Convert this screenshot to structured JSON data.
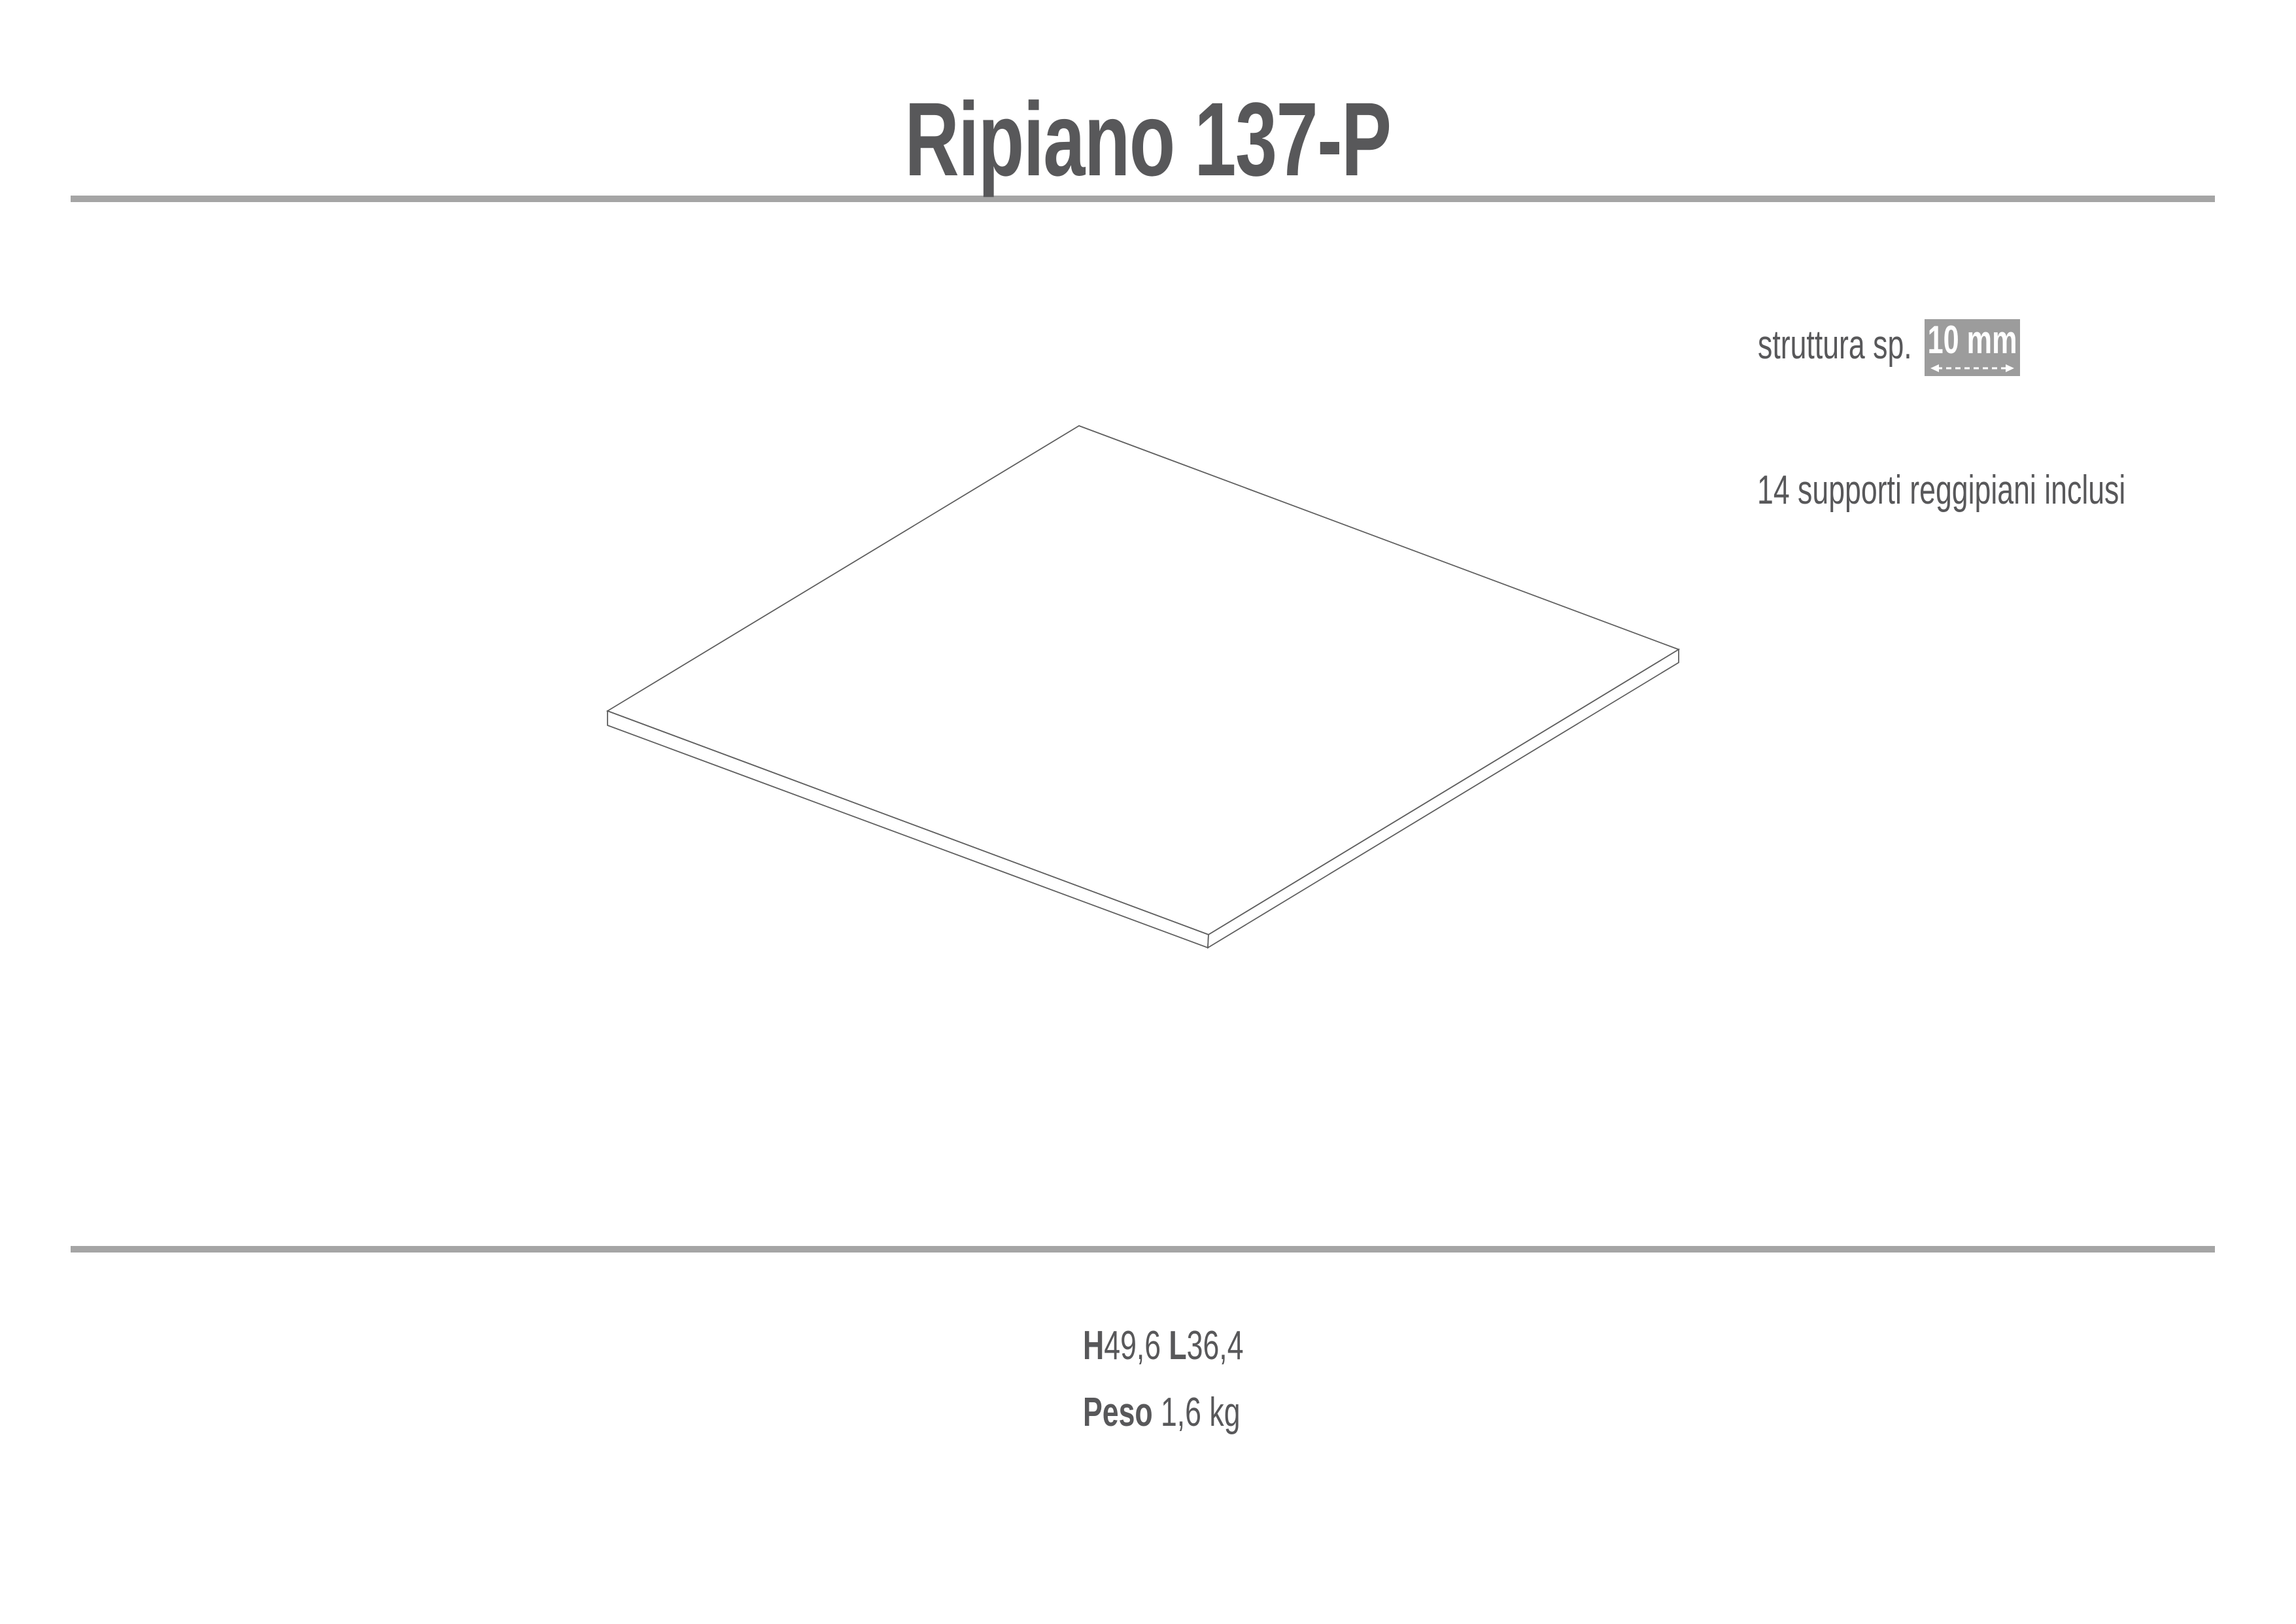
{
  "page": {
    "title": "Ripiano 137-P"
  },
  "spec": {
    "label": "struttura sp.",
    "thickness": "10 mm",
    "note": "14 supporti reggipiani inclusi"
  },
  "dims": {
    "h_label": "H",
    "h_value": "49,6",
    "l_label": "L",
    "l_value": "36,4",
    "weight_label": "Peso",
    "weight_value": "1,6 kg"
  },
  "colors": {
    "text": "#58585a",
    "rule": "#a5a5a5",
    "badge_bg": "#9c9c9c",
    "line": "#5f5f5f"
  },
  "diagram": {
    "top_face": "1650,651 2567,993 1848,1429 929,1087",
    "left_edge_face": "929,1087 929,1109 1847,1449 1848,1429",
    "right_edge_face": "1848,1429 1847,1449 2567,1013 2567,993"
  }
}
